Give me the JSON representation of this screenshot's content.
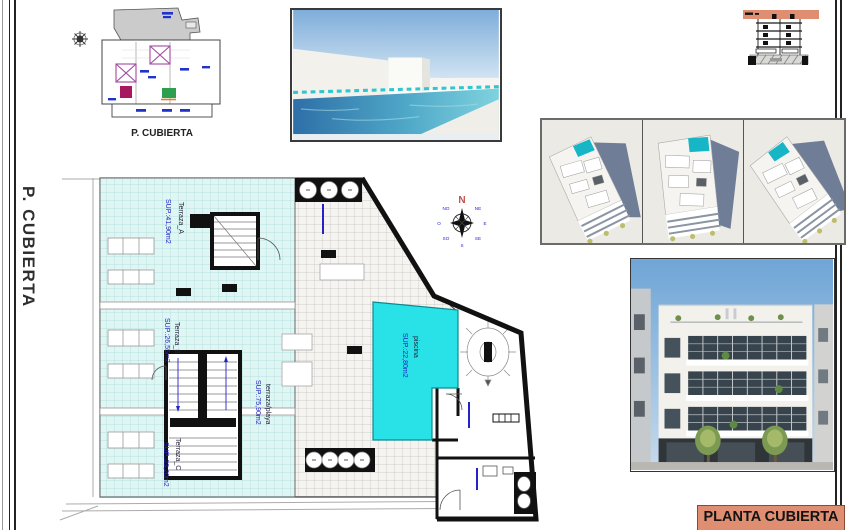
{
  "sheet": {
    "side_label": "P. CUBIERTA",
    "title": "PLANTA CUBIERTA"
  },
  "keyplan": {
    "caption": "P. CUBIERTA"
  },
  "plan": {
    "rooms": [
      {
        "name": "Terraza_A",
        "area": "SUP.:41,90m2"
      },
      {
        "name": "Terraza_B",
        "area": "SUP.:26,55m2"
      },
      {
        "name": "Terraza_C",
        "area": "SUP.:23,20m2"
      },
      {
        "name": "terraza/playa",
        "area": "SUP.:75,90m2"
      },
      {
        "name": "piscina",
        "area": "SUP.:22,80m2"
      }
    ],
    "compass": {
      "north": "N",
      "points": [
        "NE",
        "E",
        "SE",
        "S",
        "SO",
        "O",
        "NO"
      ]
    }
  },
  "colors": {
    "accent_salmon": "#df8e72",
    "pool_cyan": "#29e2e8",
    "terrace_tint": "#e0f6f4",
    "label_blue": "#2323c8",
    "linework": "#1a1a1a",
    "render_sky": "#7fadda",
    "shadow_slate": "#6f7d96"
  }
}
